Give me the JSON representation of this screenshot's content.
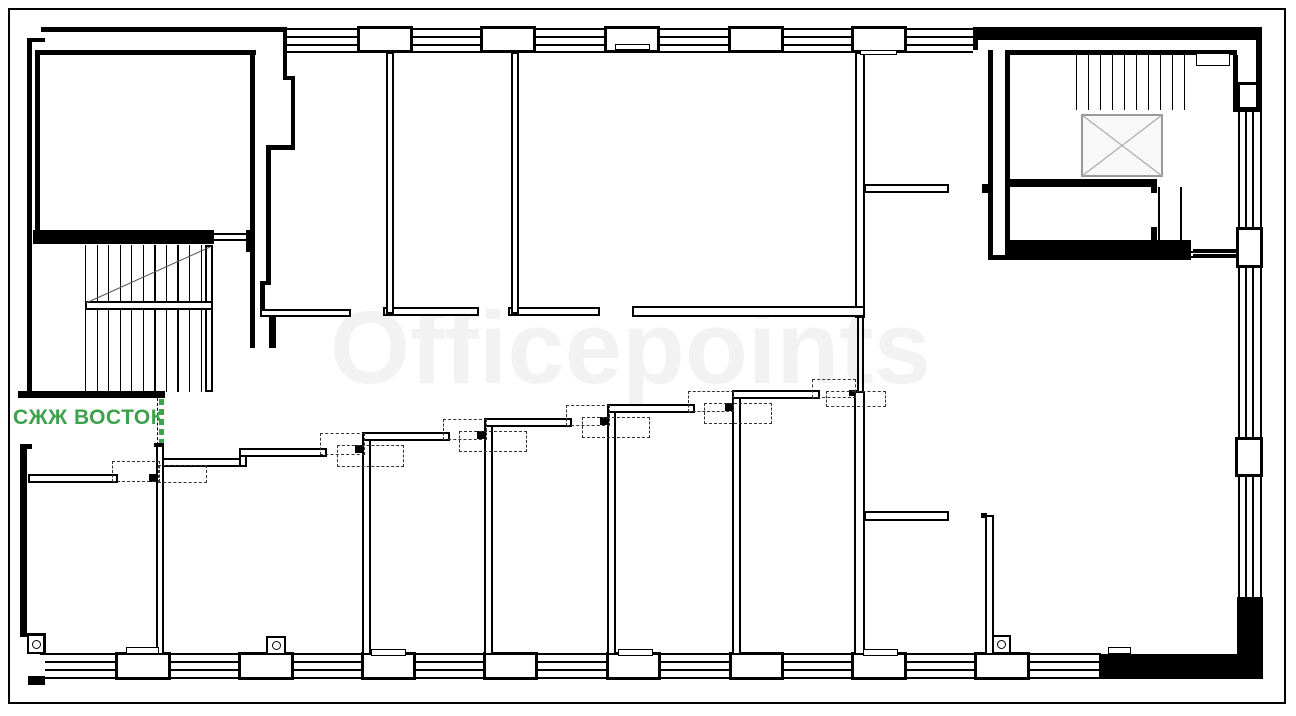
{
  "watermark": {
    "text": "Officepoints",
    "color": "#f2f2f2"
  },
  "entrance_label": {
    "text": "СЖЖ ВОСТОК",
    "color": "#3da24b"
  },
  "colors": {
    "wall": "#000000",
    "background": "#ffffff",
    "elevator_fill": "#f8f8f8",
    "elevator_line": "#999999",
    "stair_diagonal": "#555555"
  }
}
